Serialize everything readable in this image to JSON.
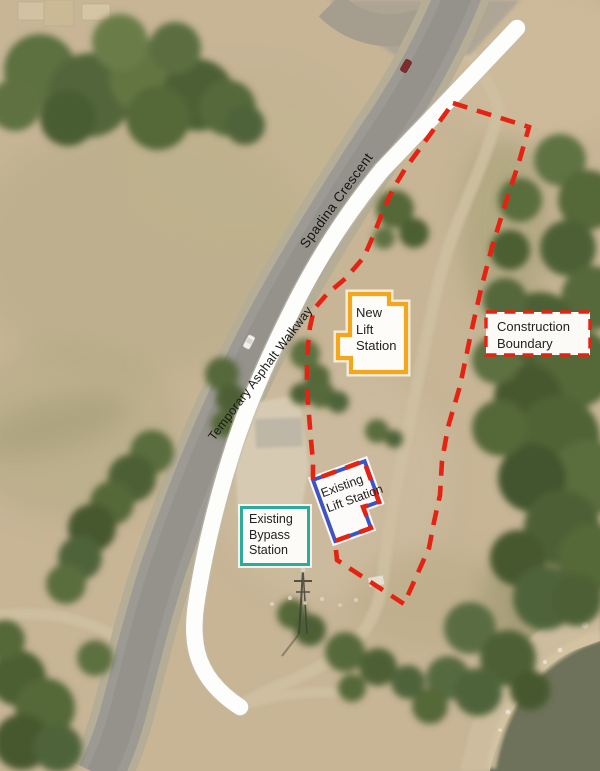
{
  "annotations": {
    "road_label": "Spadina Crescent",
    "walkway_label": "Temporary Asphalt Walkway",
    "construction_boundary": {
      "text": "Construction\nBoundary",
      "color": "#E42313"
    },
    "new_lift_station": {
      "text": "New\nLift\nStation",
      "color": "#F2A71D"
    },
    "existing_lift_station": {
      "text": "Existing\nLift Station",
      "color": "#3E54C4"
    },
    "existing_bypass_station": {
      "text": "Existing\nBypass\nStation",
      "color": "#2BAC9A"
    }
  }
}
